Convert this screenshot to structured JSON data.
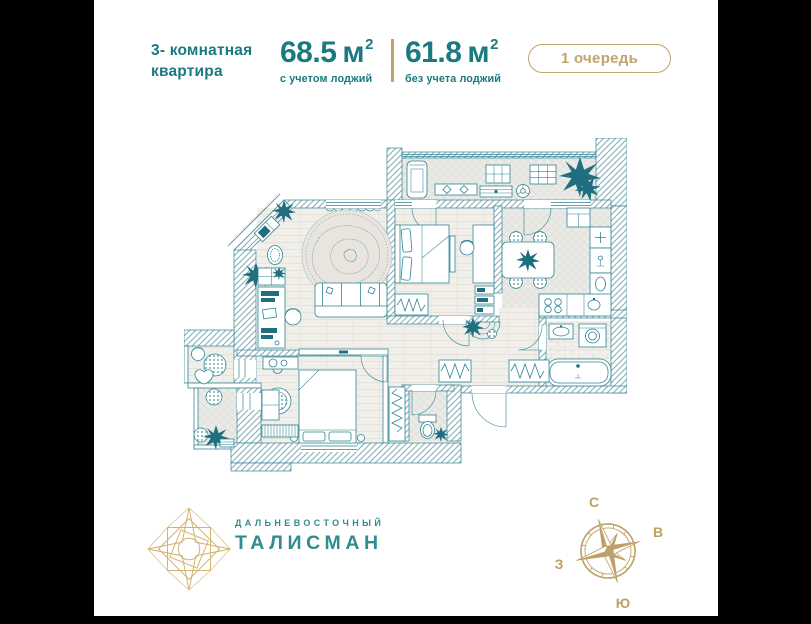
{
  "colors": {
    "teal": "#1a7a80",
    "gold": "#c2a36e",
    "plan_stroke": "#2f8496",
    "plan_hatch": "#7fb3bd",
    "logo_teal": "#2f8d91",
    "dark_accent": "#1f6f80",
    "bg": "#000000",
    "card": "#ffffff"
  },
  "header": {
    "apartment_type_line1": "3- комнатная",
    "apartment_type_line2": "квартира",
    "area_with_loggia": {
      "value": "68.5",
      "unit": "м",
      "superscript": "2",
      "caption": "с учетом лоджий"
    },
    "area_without_loggia": {
      "value": "61.8",
      "unit": "м",
      "superscript": "2",
      "caption": "без учета лоджий"
    },
    "phase_badge": "1 очередь"
  },
  "footer": {
    "developer_name_small": "ДАЛЬНЕВОСТОЧНЫЙ",
    "developer_name_large": "ТАЛИСМАН",
    "compass": {
      "north": "С",
      "east": "В",
      "south": "Ю",
      "west": "З"
    }
  }
}
